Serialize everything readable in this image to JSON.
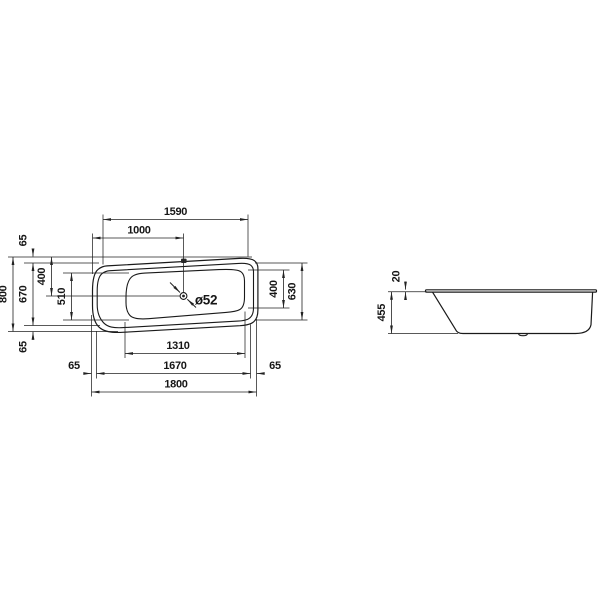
{
  "drawing": {
    "background": "#ffffff",
    "outline_color": "#1a1a1a",
    "dim_color": "#222222",
    "text_color": "#161616",
    "values_mm": [
      1590,
      1000,
      65,
      800,
      670,
      400,
      510,
      400,
      630,
      65,
      65,
      1670,
      65,
      1310,
      1800,
      52,
      20,
      455
    ],
    "h_dims": [
      {
        "label": "1590",
        "y": 219.5,
        "x1": 103,
        "x2": 248,
        "lx": 175.5,
        "ly": 215
      },
      {
        "label": "1000",
        "y": 238,
        "x1": 92.5,
        "x2": 183.5,
        "lx": 139,
        "ly": 233.5
      },
      {
        "label": "1310",
        "y": 353.5,
        "x1": 125,
        "x2": 245,
        "lx": 178,
        "ly": 349
      },
      {
        "label": "1670",
        "y": 373.5,
        "x1": 96.5,
        "x2": 250.5,
        "lx": 175,
        "ly": 369
      },
      {
        "label": "1800",
        "y": 392,
        "x1": 91.5,
        "x2": 256.5,
        "lx": 176,
        "ly": 387.5
      }
    ],
    "v_dims": [
      {
        "label": "800",
        "x": 13,
        "y1": 257,
        "y2": 331.5
      },
      {
        "label": "670",
        "x": 33,
        "y1": 263,
        "y2": 325.5
      },
      {
        "label": "400",
        "x": 51.5,
        "y1": 257,
        "y2": 296
      },
      {
        "label": "510",
        "x": 71.5,
        "y1": 273,
        "y2": 320
      },
      {
        "label": "400",
        "x": 283.5,
        "y1": 270,
        "y2": 308
      },
      {
        "label": "630",
        "x": 302,
        "y1": 263,
        "y2": 320
      },
      {
        "label": "455",
        "x": 391.5,
        "y1": 291.8,
        "y2": 333.5
      }
    ],
    "stub_dims": [
      {
        "label": "65",
        "rot": true,
        "lx": 26.5,
        "ly": 240.5,
        "arrows": [
          [
            33,
            248.5,
            33,
            256.5
          ]
        ]
      },
      {
        "label": "65",
        "rot": true,
        "lx": 26.5,
        "ly": 347,
        "arrows": [
          [
            33,
            340,
            33,
            331.8
          ]
        ]
      },
      {
        "label": "65",
        "rot": false,
        "lx": 74,
        "ly": 369,
        "arrows": [
          [
            83.5,
            373.5,
            91.3,
            373.5
          ]
        ]
      },
      {
        "label": "65",
        "rot": false,
        "lx": 275,
        "ly": 369,
        "arrows": [
          [
            264.5,
            373.5,
            256.7,
            373.5
          ]
        ]
      },
      {
        "label": "20",
        "rot": true,
        "lx": 399.5,
        "ly": 276.5,
        "arrows": [
          [
            405.5,
            281.5,
            405.5,
            289.6
          ],
          [
            405.5,
            300,
            405.5,
            292
          ]
        ]
      }
    ],
    "ext_lines": [
      [
        8,
        257,
        252,
        257
      ],
      [
        24,
        263,
        99,
        263
      ],
      [
        63,
        273,
        129,
        273
      ],
      [
        46,
        296,
        180,
        296
      ],
      [
        63,
        320,
        129,
        320
      ],
      [
        24,
        325.5,
        100,
        325.5
      ],
      [
        8,
        331.5,
        118,
        331.5
      ],
      [
        255,
        263,
        307.5,
        263
      ],
      [
        248,
        270,
        289.5,
        270
      ],
      [
        248,
        308,
        289.5,
        308
      ],
      [
        255,
        320,
        307.5,
        320
      ],
      [
        103,
        214.5,
        103,
        264.5
      ],
      [
        248,
        214.5,
        248,
        256.5
      ],
      [
        92.5,
        233.5,
        92.5,
        274
      ],
      [
        183.5,
        233.5,
        183.5,
        292.3
      ],
      [
        125,
        322,
        125,
        358
      ],
      [
        245,
        311.5,
        245,
        358
      ],
      [
        96.5,
        331,
        96.5,
        378.5
      ],
      [
        250.5,
        324.5,
        250.5,
        378.5
      ],
      [
        91.5,
        315,
        91.5,
        396.5
      ],
      [
        256.5,
        319,
        256.5,
        396.5
      ],
      [
        388,
        291.8,
        427,
        291.8
      ],
      [
        388,
        333.5,
        458,
        333.5
      ]
    ],
    "leader": {
      "label": "ø52",
      "lx": 206,
      "ly": 304.5,
      "arrows": [
        [
          170,
          282.5,
          180,
          292.5
        ],
        [
          196,
          307.5,
          187.3,
          299.3
        ]
      ]
    },
    "drain": {
      "cx": 183.5,
      "cy": 296,
      "r_outer": 3.4,
      "r_inner": 1.4
    }
  }
}
